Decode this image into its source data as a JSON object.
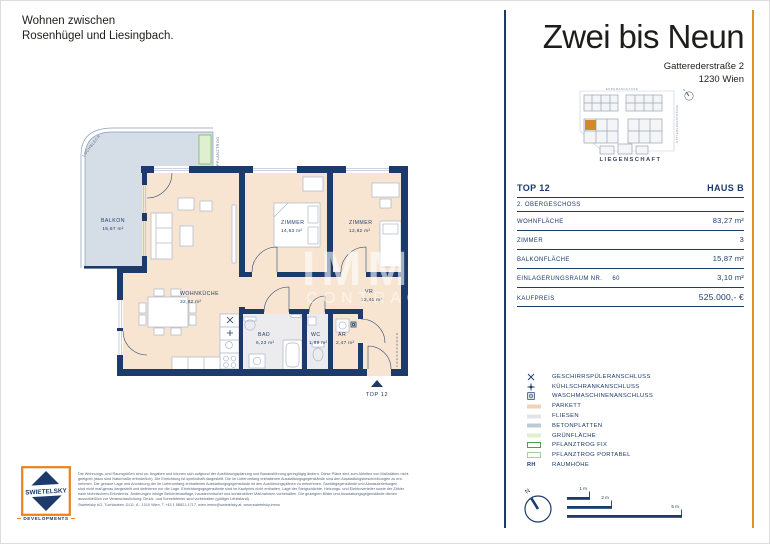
{
  "page": {
    "tagline": [
      "Wohnen zwischen",
      "Rosenhügel und Liesingbach."
    ]
  },
  "header": {
    "brand": "Zwei bis Neun",
    "address1": "Gatterederstraße 2",
    "address2": "1230 Wien"
  },
  "site_plan": {
    "street_top": "ENDEMANNGASSE",
    "street_right": "GATTEREDERSTRASSE",
    "caption": "LIEGENSCHAFT",
    "compass": "N",
    "highlight_color": "#d08a2a"
  },
  "unit": {
    "top": "TOP 12",
    "haus": "HAUS B",
    "floor": "2. OBERGESCHOSS",
    "rows": [
      {
        "label": "WOHNFLÄCHE",
        "num": "",
        "value": "83,27 m²"
      },
      {
        "label": "ZIMMER",
        "num": "",
        "value": "3"
      },
      {
        "label": "BALKONFLÄCHE",
        "num": "",
        "value": "15,87 m²"
      },
      {
        "label": "EINLAGERUNGSRAUM NR.",
        "num": "60",
        "value": "3,10 m²"
      },
      {
        "label": "KAUFPREIS",
        "num": "",
        "value": "525.000,- €"
      }
    ]
  },
  "legend": {
    "items": [
      {
        "label": "GESCHIRRSPÜLERANSCHLUSS"
      },
      {
        "label": "KÜHLSCHRANKANSCHLUSS"
      },
      {
        "label": "WASCHMASCHINENANSCHLUSS"
      },
      {
        "label": "PARKETT",
        "swatch": "#efd3b4"
      },
      {
        "label": "FLIESEN",
        "swatch": "#e4e4e8"
      },
      {
        "label": "BETONPLATTEN",
        "swatch": "#bcc9d6"
      },
      {
        "label": "GRÜNFLÄCHE",
        "swatch": "#def0cf"
      },
      {
        "label": "PFLANZTROG FIX",
        "box": "#4f9e50"
      },
      {
        "label": "PFLANZTROG PORTABEL",
        "box": "#a5cf9b"
      },
      {
        "label": "RAUMHÖHE",
        "text": "RH"
      }
    ]
  },
  "floorplan": {
    "rooms": {
      "balkon": {
        "name": "BALKON",
        "area": "15,87 m²"
      },
      "wohnkueche": {
        "name": "WOHNKÜCHE",
        "area": "32,82 m²"
      },
      "zimmer1": {
        "name": "ZIMMER",
        "area": "14,63 m²"
      },
      "zimmer2": {
        "name": "ZIMMER",
        "area": "12,82 m²"
      },
      "vr": {
        "name": "VR",
        "area": "12,41 m²"
      },
      "bad": {
        "name": "BAD",
        "area": "6,23 m²"
      },
      "wc": {
        "name": "WC",
        "area": "1,89 m²"
      },
      "ar": {
        "name": "AR",
        "area": "2,47 m²"
      }
    },
    "annotations": {
      "lochblech": "LOCHBLECH",
      "pflanztrog": "PFLANZTROG",
      "entrance": "TOP 12"
    },
    "watermark": [
      "IMMO",
      "CONTRACT"
    ]
  },
  "scalebar": {
    "labels": [
      "1 m",
      "2 m",
      "5 m"
    ],
    "compass": "N"
  },
  "footer": {
    "logo": {
      "brand": "SWIETELSKY",
      "sub": "DEVELOPMENTS"
    },
    "disclaimer": [
      "Die Wohnungs- und Raumgrößen sind ca. Angaben und können sich aufgrund der Ausführungsplanung und Bauausführung geringfügig ändern. Diese Pläne sind zum Ableiten von Maßstäben nicht",
      "geeignet (dazu sind Naturmaße erforderlich). Die Einrichtung ist symbolhaft dargestellt. Die im Lieferumfang enthaltenen Ausstattungsgegenstände sind den Ausstattungsbeschreibungen zu ent-",
      "nehmen. Die genaue Lage und Anordnung der im Lieferumfang enthaltenen Ausstattungsgegenstände ist den Ausführungsplänen zu entnehmen. Sanitärgegenstände und Abwasserleitungen",
      "sind nicht maßgenau dargestellt und definieren nur die Lage. Einrichtungsgegenstände sind im Kaufpreis nicht enthalten. Lage der Steigschächte, Heizungs- und Elektroverteiler sowie der Zähler",
      "nach technischem Erfordernis. Änderungen infolge Behördenauflage, haustechnischer und konstruktiver Maßnahmen vorbehalten. Die gezeigten Bilder und Ausstattungsgegenstände dienen",
      "ausschließlich zur Veranschaulichung. Druck- und Schreibfehler sind vorbehalten (gültiger Letztstand)."
    ],
    "contact": "Swietelsky AG, Tuchlauben 11/11, A - 1010 Wien, T +43 1 58821-1717, wien.immo@swietelsky.at, www.swietelsky.immo"
  },
  "colors": {
    "navy": "#1c3a6a",
    "orange": "#e2931f",
    "parkett": "#f7e5d1",
    "betonplatten": "#d5dde7",
    "fliesen": "#ececef",
    "gruenflaeche": "#def0cf"
  }
}
